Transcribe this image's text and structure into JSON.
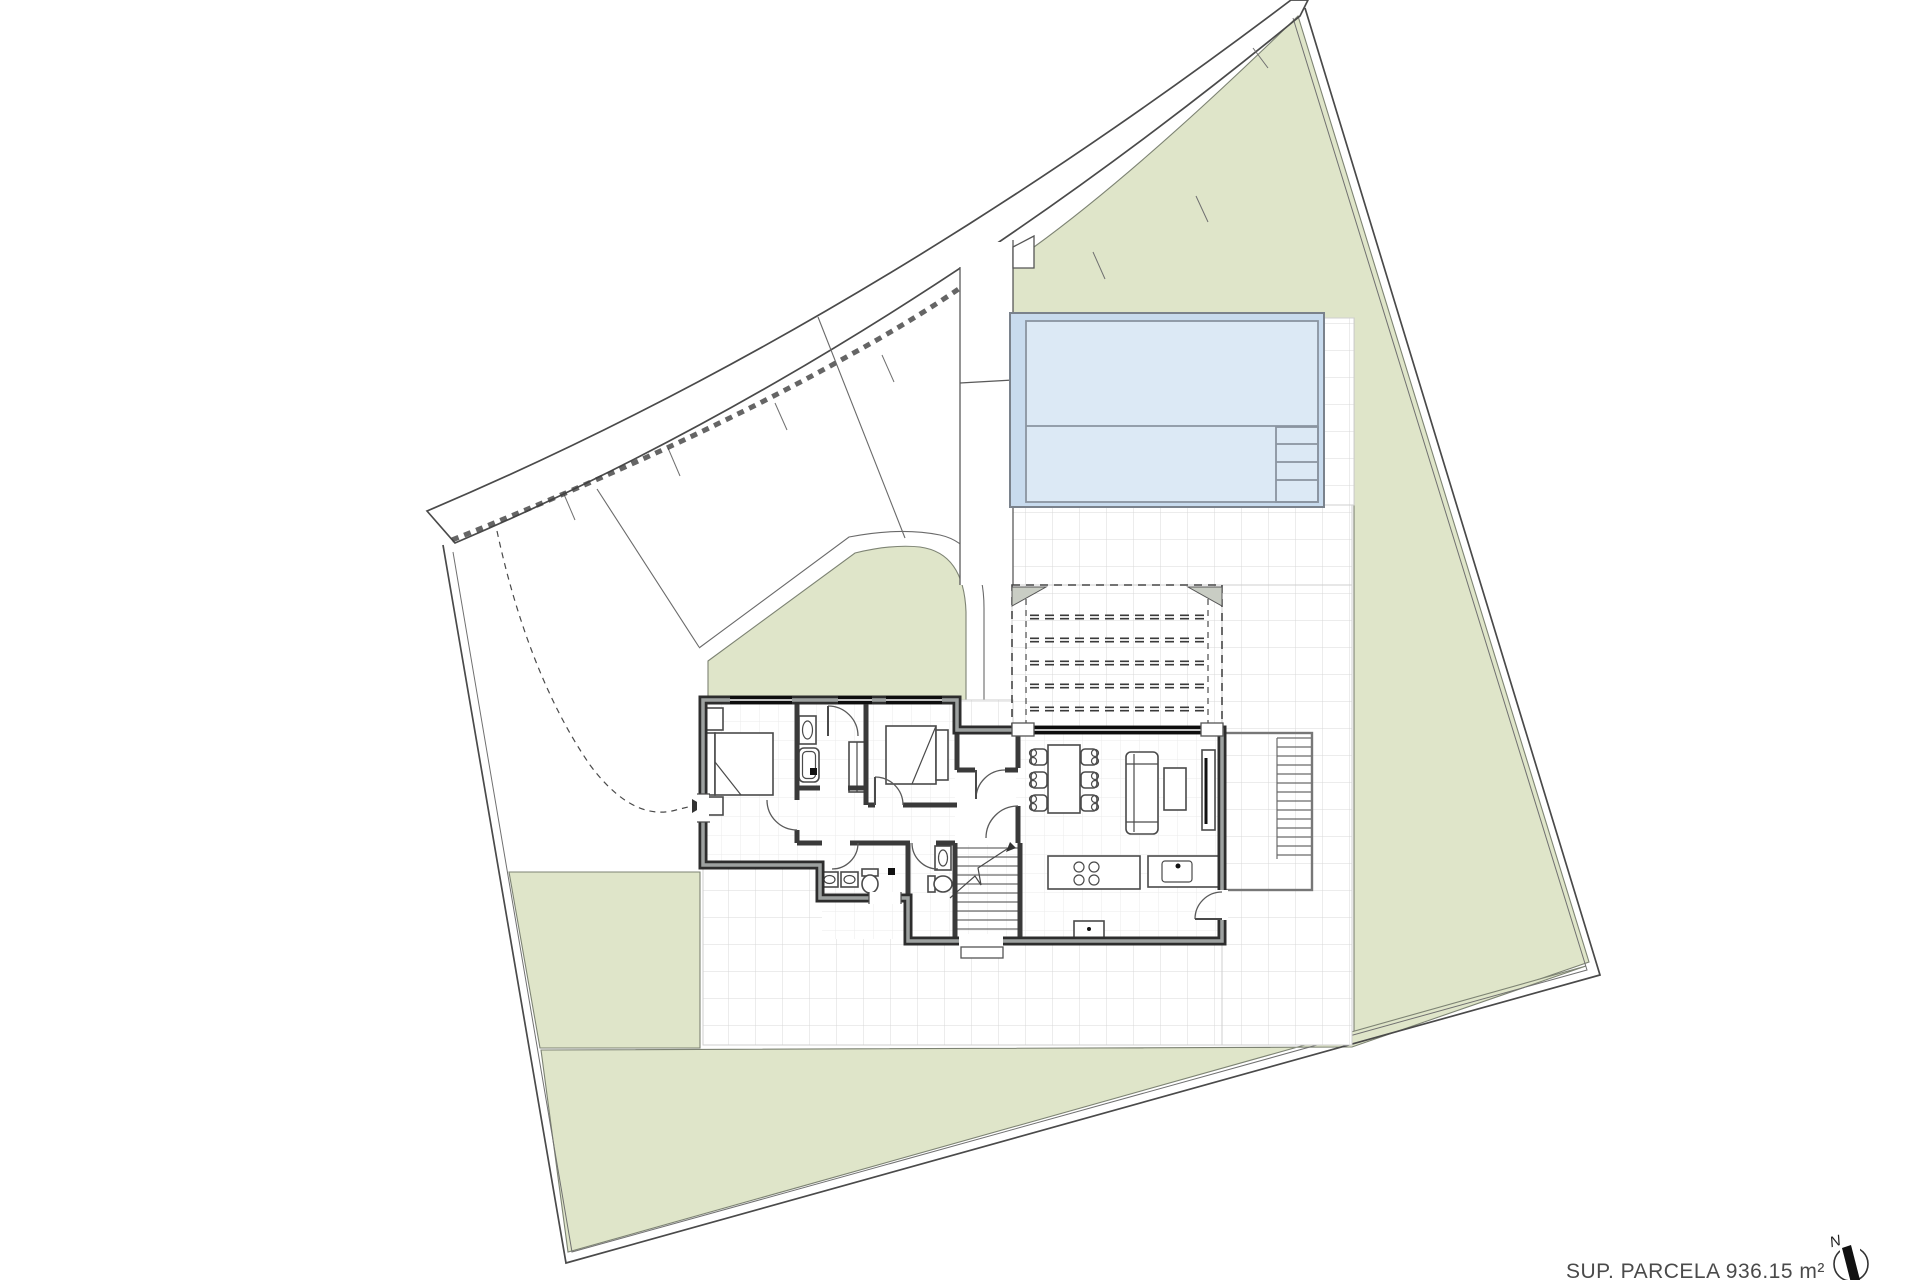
{
  "plan": {
    "area_label": "SUP. PARCELA 936.15 m²",
    "north_label": "N"
  },
  "colors": {
    "lawn": "#dfe5c9",
    "road": "#e9e9e6",
    "pool_border": "#c8dbee",
    "pool_water": "#dce9f5",
    "pool_grid": "#b3c6dc",
    "terrace_grid": "#d8d8d8",
    "floor_grid": "#ebebeb",
    "pergola_bracket": "#c9cdc4",
    "wall": "#2d2d2d"
  }
}
